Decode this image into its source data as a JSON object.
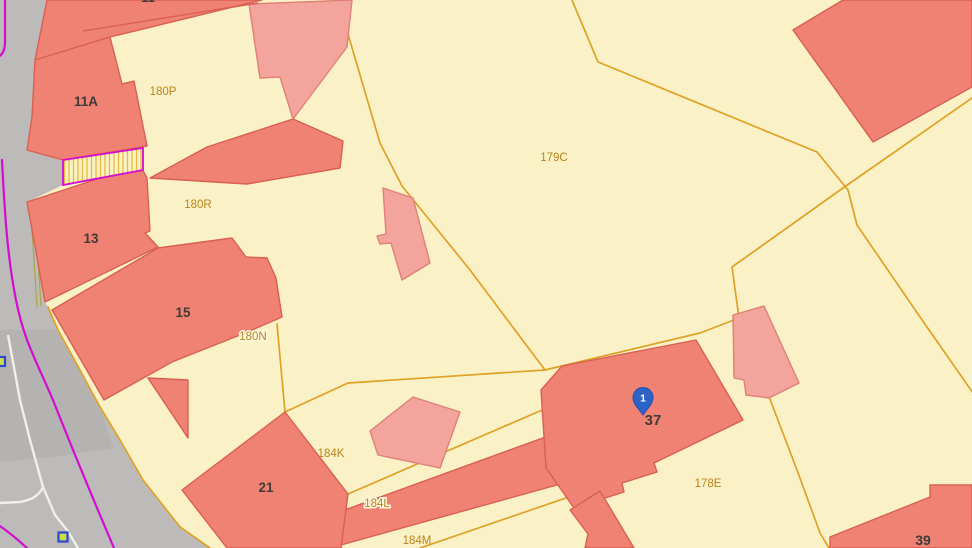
{
  "title": "Cadastral parcel map",
  "colors": {
    "cream": "#FAF2C6",
    "road_gray": "#BCBBBA",
    "road_gray_dark": "#B5B3B2",
    "building_fill": "#F08273",
    "building_stroke": "#D95F53",
    "building_light_fill": "#F3A49D",
    "building_light_stroke": "#E08076",
    "parcel_line": "#DFA126",
    "parcel_label": "#BA831B",
    "building_label": "#3F3B36",
    "white_line": "#F0EFEB",
    "magenta_line": "#D40CD0",
    "olive_line": "#A9A750",
    "hatch_line": "#E8B93F",
    "marker_blue": "#2A46D4",
    "marker_green": "#CBE045",
    "pin_fill": "#2E63C6",
    "pin_stroke": "#1E4DB7",
    "pin_text": "#FFFFFF"
  },
  "map": {
    "building_labels": {
      "partial": "11",
      "b11a": "11A",
      "b13": "13",
      "b15": "15",
      "b21": "21",
      "b37": "37",
      "b39": "39"
    },
    "parcel_labels": {
      "p180p": "180P",
      "p180r": "180R",
      "p180n": "180N",
      "p179c": "179C",
      "p184k": "184K",
      "p184l": "184L",
      "p184m": "184M",
      "p178e": "178E"
    },
    "pin": {
      "label": "1"
    }
  }
}
